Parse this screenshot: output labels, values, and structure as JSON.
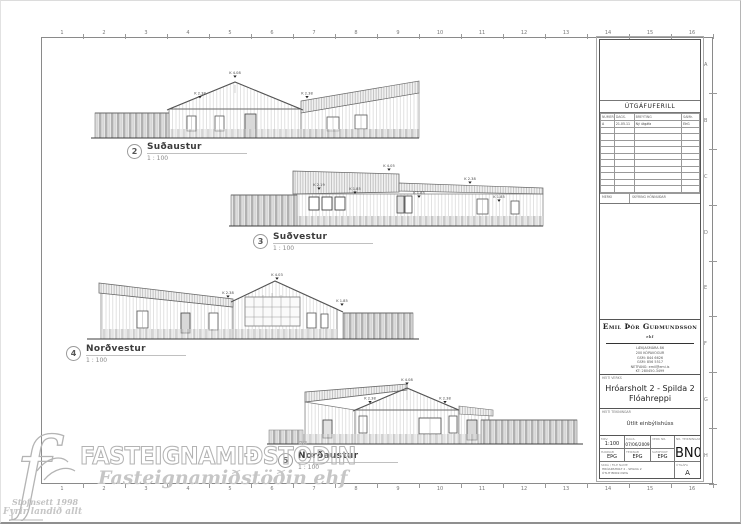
{
  "sheet": {
    "ruler_numbers": [
      "1",
      "2",
      "3",
      "4",
      "5",
      "6",
      "7",
      "8",
      "9",
      "10",
      "11",
      "12",
      "13",
      "14",
      "15",
      "16"
    ],
    "ruler_letters": [
      "A",
      "B",
      "C",
      "D",
      "E",
      "F",
      "G",
      "H"
    ]
  },
  "elevations": [
    {
      "num": "2",
      "name": "Suðaustur",
      "scale": "1 : 100",
      "markers": [
        "K 4.08",
        "K 2.38",
        "K 2.38"
      ]
    },
    {
      "num": "3",
      "name": "Suðvestur",
      "scale": "1 : 100",
      "markers": [
        "K 4.05",
        "K 2.19",
        "K 1.85",
        "K 2.38",
        "K 1.85",
        "K 1.85"
      ]
    },
    {
      "num": "4",
      "name": "Norðvestur",
      "scale": "1 : 100",
      "markers": [
        "K 4.03",
        "K 2.38",
        "K 1.85"
      ]
    },
    {
      "num": "5",
      "name": "Norðaustur",
      "scale": "1 : 100",
      "markers": [
        "K 4.08",
        "K 2.38",
        "K 2.38"
      ]
    }
  ],
  "titleblock": {
    "revision": {
      "title": "ÚTGÁFUFERILL",
      "headers": [
        "NÚMER",
        "DAGS.",
        "BREYTING",
        "SAMÞ."
      ],
      "rows": [
        [
          "A",
          "21.05.11",
          "Ný útgáfa",
          "EÞG"
        ]
      ],
      "empty_rows": 10,
      "footer_left": "MERKI",
      "footer_right": "SKÝRING HÖNNUÐAR"
    },
    "company": {
      "name": "Emil Þór Guðmundsson",
      "suffix": "ehf",
      "address_lines": [
        "LÆKJASMÁRA 86",
        "200 KÓPAVOGUR",
        "GSM: 844 6626",
        "GSM: 856 5517",
        "NETFANG: emil@emi.is",
        "KT: 280450-3499"
      ]
    },
    "project": {
      "label": "HEITI VERKS",
      "line1": "Hróarsholt 2 - Spilda 2",
      "line2": "Flóahreppi"
    },
    "drawing": {
      "label": "HEITI TEIKNINGAR",
      "title": "Útlit einbýlishúss"
    },
    "info": {
      "scale_label": "MKV.",
      "scale": "1:100",
      "date_label": "DAGS.",
      "date": "07/06/2009",
      "job_label": "VERK NR.",
      "job": "",
      "designed_label": "HANNAÐ",
      "designed": "EÞG",
      "drawn_label": "TEIKNAÐ",
      "drawn": "EÞG",
      "approved_label": "SAMÞYKKT",
      "approved": "EÞG",
      "number_label": "NR. TEIKNINGAR",
      "number": "BN02",
      "file_label": "SKRÁ / FILE NAME",
      "file_lines": [
        "HRÓARSHOLT 2 - SPILDA 2",
        "ÚTLIT BN02.DWG"
      ],
      "issue_label": "ÚTGÁFA",
      "issue": "A"
    }
  },
  "watermark": {
    "brand": "FASTEIGNAMIÐSTÖÐIN",
    "script": "Fasteignamiðstöðin ehf",
    "logo_letter": "f",
    "line1": "Stofnsett 1998",
    "line2": "Fyrir landið allt"
  }
}
